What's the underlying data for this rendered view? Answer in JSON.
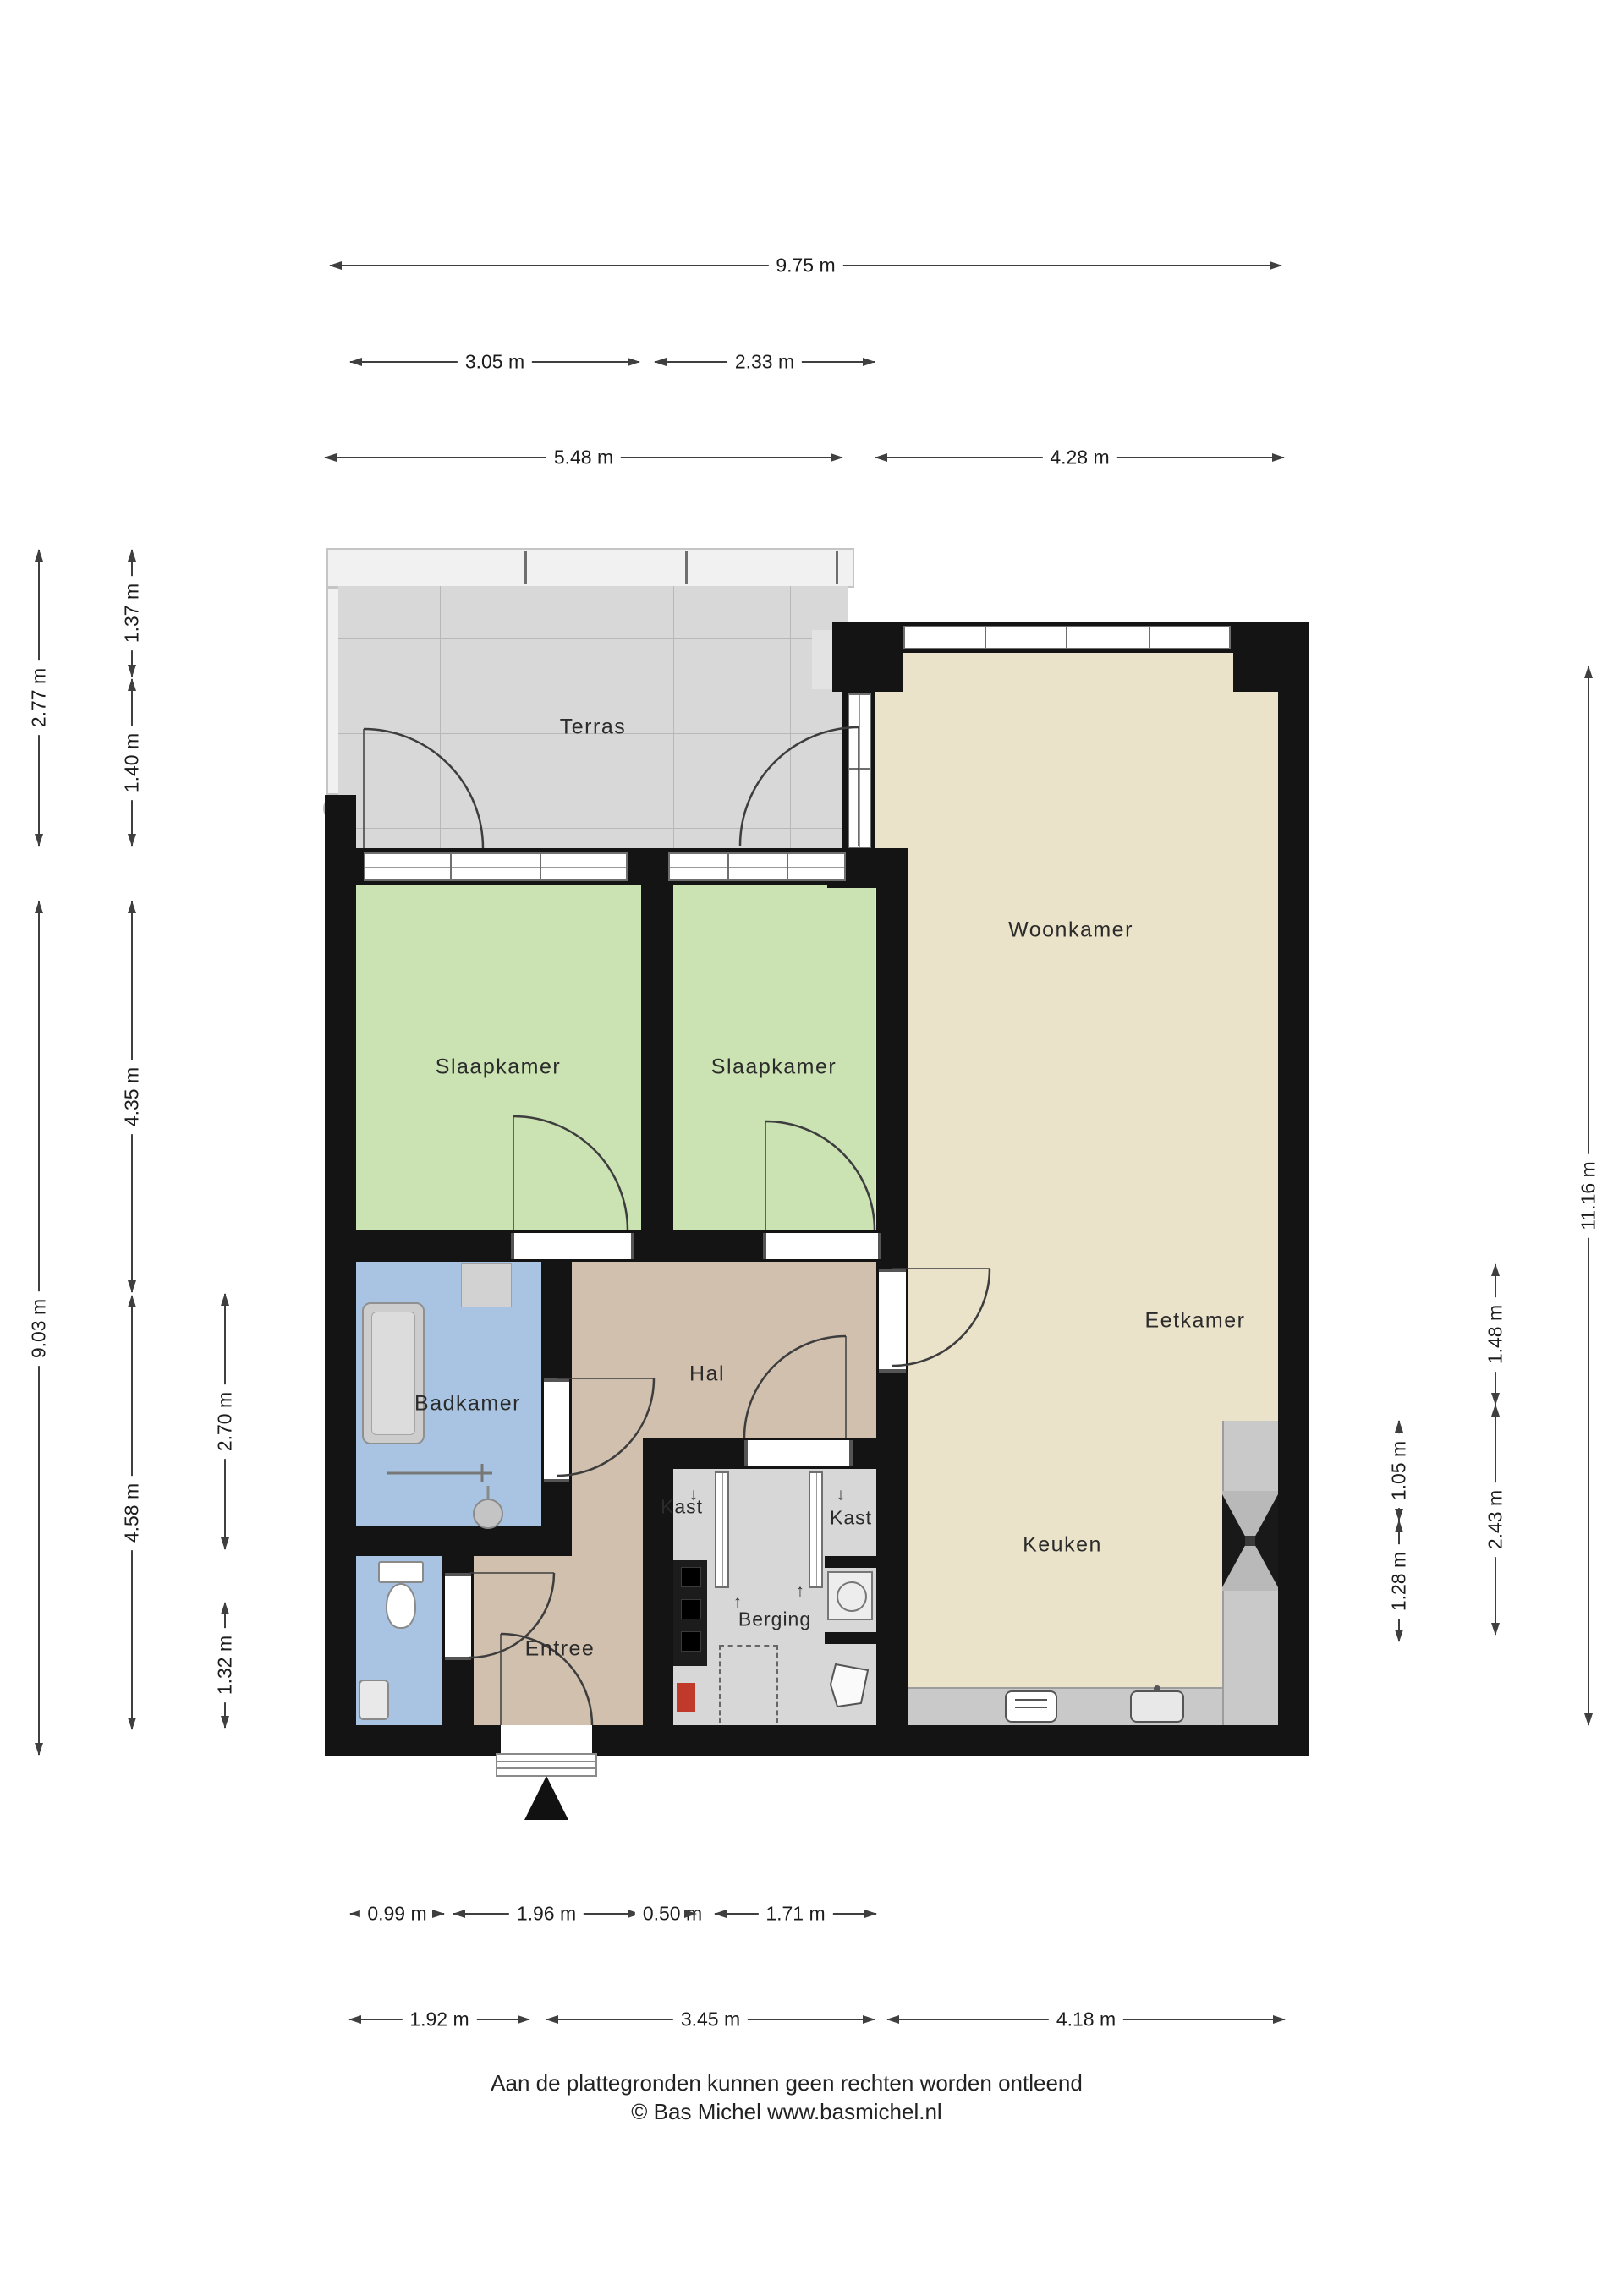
{
  "plan": {
    "rooms": {
      "terras": "Terras",
      "woonkamer": "Woonkamer",
      "eetkamer": "Eetkamer",
      "keuken": "Keuken",
      "slaapkamer_links": "Slaapkamer",
      "slaapkamer_rechts": "Slaapkamer",
      "badkamer": "Badkamer",
      "hal": "Hal",
      "entree": "Entree",
      "berging": "Berging",
      "kast_links": "Kast",
      "kast_rechts": "Kast"
    },
    "colors": {
      "wall": "#141414",
      "terras_floor": "#d8d8d8",
      "bedroom_green": "#cbe2b2",
      "living_beige": "#eae2c9",
      "hall_tan": "#d1c0ae",
      "bath_blue": "#a9c4e2",
      "closet_grey": "#d7d7d7",
      "counter_grey": "#c9c9c9"
    },
    "slide_marks": {
      "down": "↓",
      "up": "↑"
    }
  },
  "dims": {
    "top_total": "9.75 m",
    "top_a": "3.05 m",
    "top_b": "2.33 m",
    "top_c": "5.48 m",
    "top_d": "4.28 m",
    "bottom_a": "0.99 m",
    "bottom_b": "1.96 m",
    "bottom_c": "0.50 m",
    "bottom_d": "1.71 m",
    "bottom_e": "1.92 m",
    "bottom_f": "3.45 m",
    "bottom_g": "4.18 m",
    "left_a": "2.77 m",
    "left_b": "9.03 m",
    "left_c": "1.37 m",
    "left_d": "1.40 m",
    "left_e": "4.35 m",
    "left_f": "4.58 m",
    "left_g": "2.70 m",
    "left_h": "1.32 m",
    "right_a": "11.16 m",
    "right_b": "1.48 m",
    "right_c": "2.43 m",
    "right_d": "1.05 m",
    "right_e": "1.28 m"
  },
  "footer": {
    "line1": "Aan de plattegronden kunnen geen rechten worden ontleend",
    "line2": "© Bas Michel www.basmichel.nl"
  }
}
